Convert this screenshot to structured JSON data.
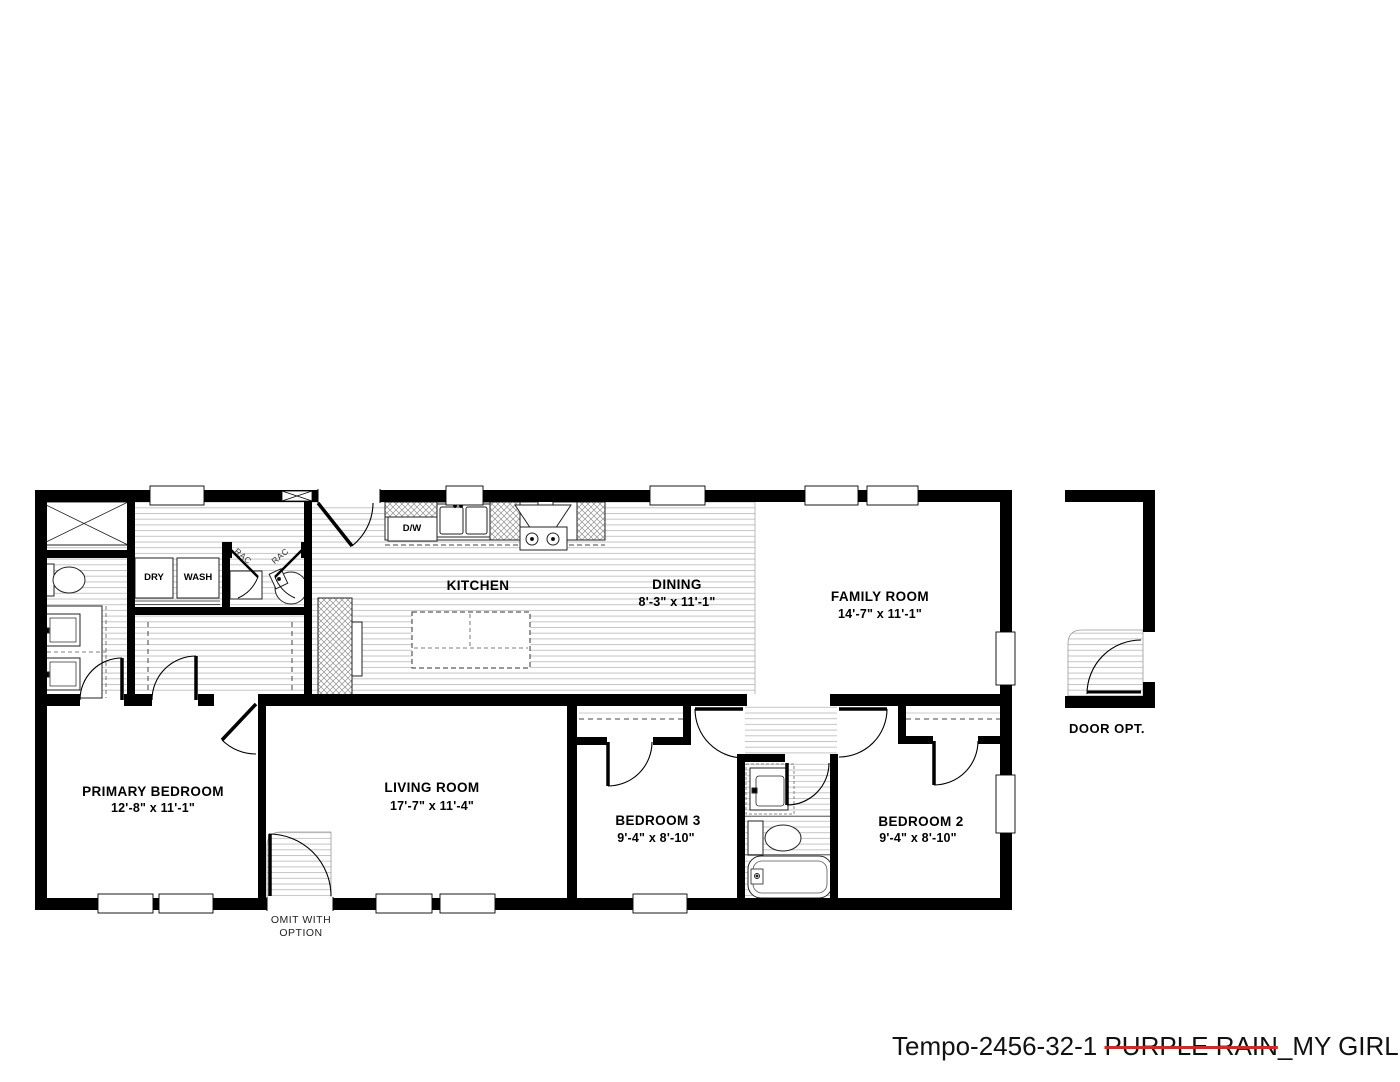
{
  "title": {
    "prefix": "Tempo-2456-32-1 ",
    "strikethrough": "PURPLE RAIN",
    "suffix": "_MY GIRL"
  },
  "rooms": {
    "kitchen": {
      "name": "KITCHEN",
      "dims": ""
    },
    "dining": {
      "name": "DINING",
      "dims": "8'-3\" x  11'-1\""
    },
    "family_room": {
      "name": "FAMILY ROOM",
      "dims": "14'-7\" x  11'-1\""
    },
    "primary_bedroom": {
      "name": "PRIMARY BEDROOM",
      "dims": "12'-8\" x  11'-1\""
    },
    "living_room": {
      "name": "LIVING ROOM",
      "dims": "17'-7\" x  11'-4\""
    },
    "bedroom3": {
      "name": "BEDROOM 3",
      "dims": "9'-4\" x  8'-10\""
    },
    "bedroom2": {
      "name": "BEDROOM 2",
      "dims": "9'-4\" x  8'-10\""
    }
  },
  "labels": {
    "dryer": "DRY",
    "washer": "WASH",
    "dishwasher": "D/W",
    "rac_left": "RAC",
    "rac_right": "RAC",
    "door_option": "DOOR OPT.",
    "omit_note_line1": "OMIT  WITH",
    "omit_note_line2": "OPTION"
  },
  "colors": {
    "wall": "#000000",
    "strikethrough_red": "#cc2b2b",
    "hatch_line": "#c4c4c4"
  }
}
